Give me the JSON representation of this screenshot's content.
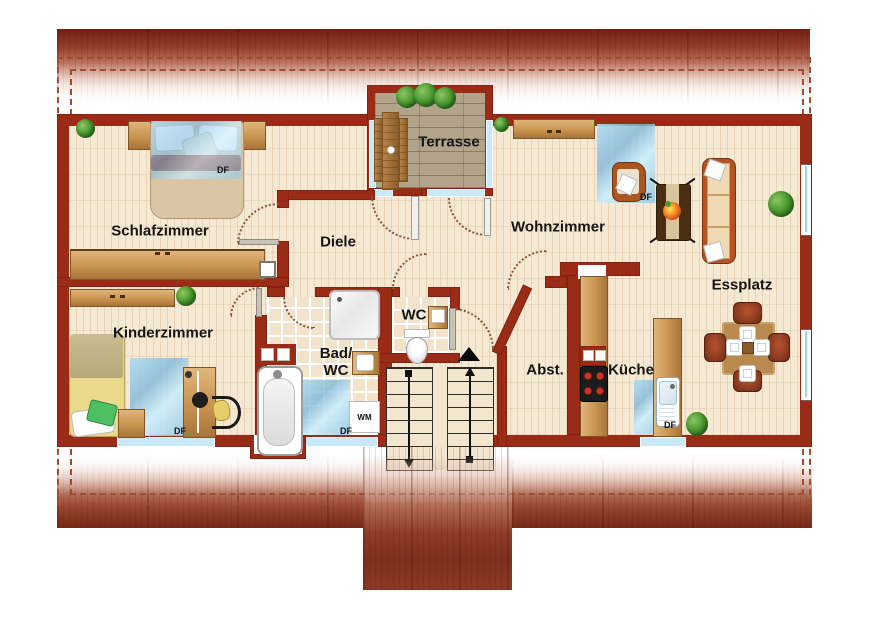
{
  "palette": {
    "wall": "#9a2b16",
    "roof_dark": "#762816",
    "floor_wood": "#f5e9d3",
    "terrace_deck": "#b2a38a",
    "bath_tile": "#f2e3ca",
    "skylight_blue": "#a9d3ec",
    "window_blue": "#c9e9f7",
    "furniture_wood": "#c8944f",
    "label_color": "#151515"
  },
  "rooms": {
    "schlafzimmer": "Schlafzimmer",
    "kinderzimmer": "Kinderzimmer",
    "diele": "Diele",
    "terrasse": "Terrasse",
    "wohnzimmer": "Wohnzimmer",
    "essplatz": "Essplatz",
    "bad": "Bad/\nWC",
    "wc": "WC",
    "abstellraum": "Abst.",
    "kueche": "Küche"
  },
  "markers": {
    "skylight": "DF",
    "washing_machine": "WM"
  }
}
